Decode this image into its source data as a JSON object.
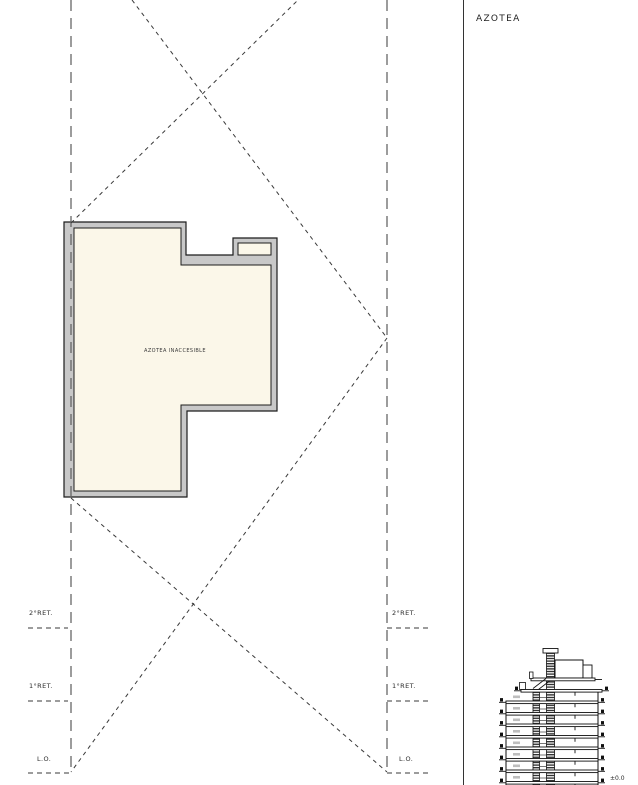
{
  "page": {
    "title": "AZOTEA"
  },
  "plan": {
    "area_label": "AZOTEA INACCESIBLE"
  },
  "markers": {
    "left": {
      "ret2": "2°RET.",
      "ret1": "1°RET.",
      "lo": "L.O."
    },
    "right": {
      "ret2": "2°RET.",
      "ret1": "1°RET.",
      "lo": "L.O."
    }
  },
  "section": {
    "level": "±0.0"
  },
  "colors": {
    "wall_fill": "#c8c8c8",
    "roof_fill": "#fbf7e9",
    "line": "#222222",
    "dash_dark": "#3a3a3a",
    "dash_gray": "#666666"
  }
}
